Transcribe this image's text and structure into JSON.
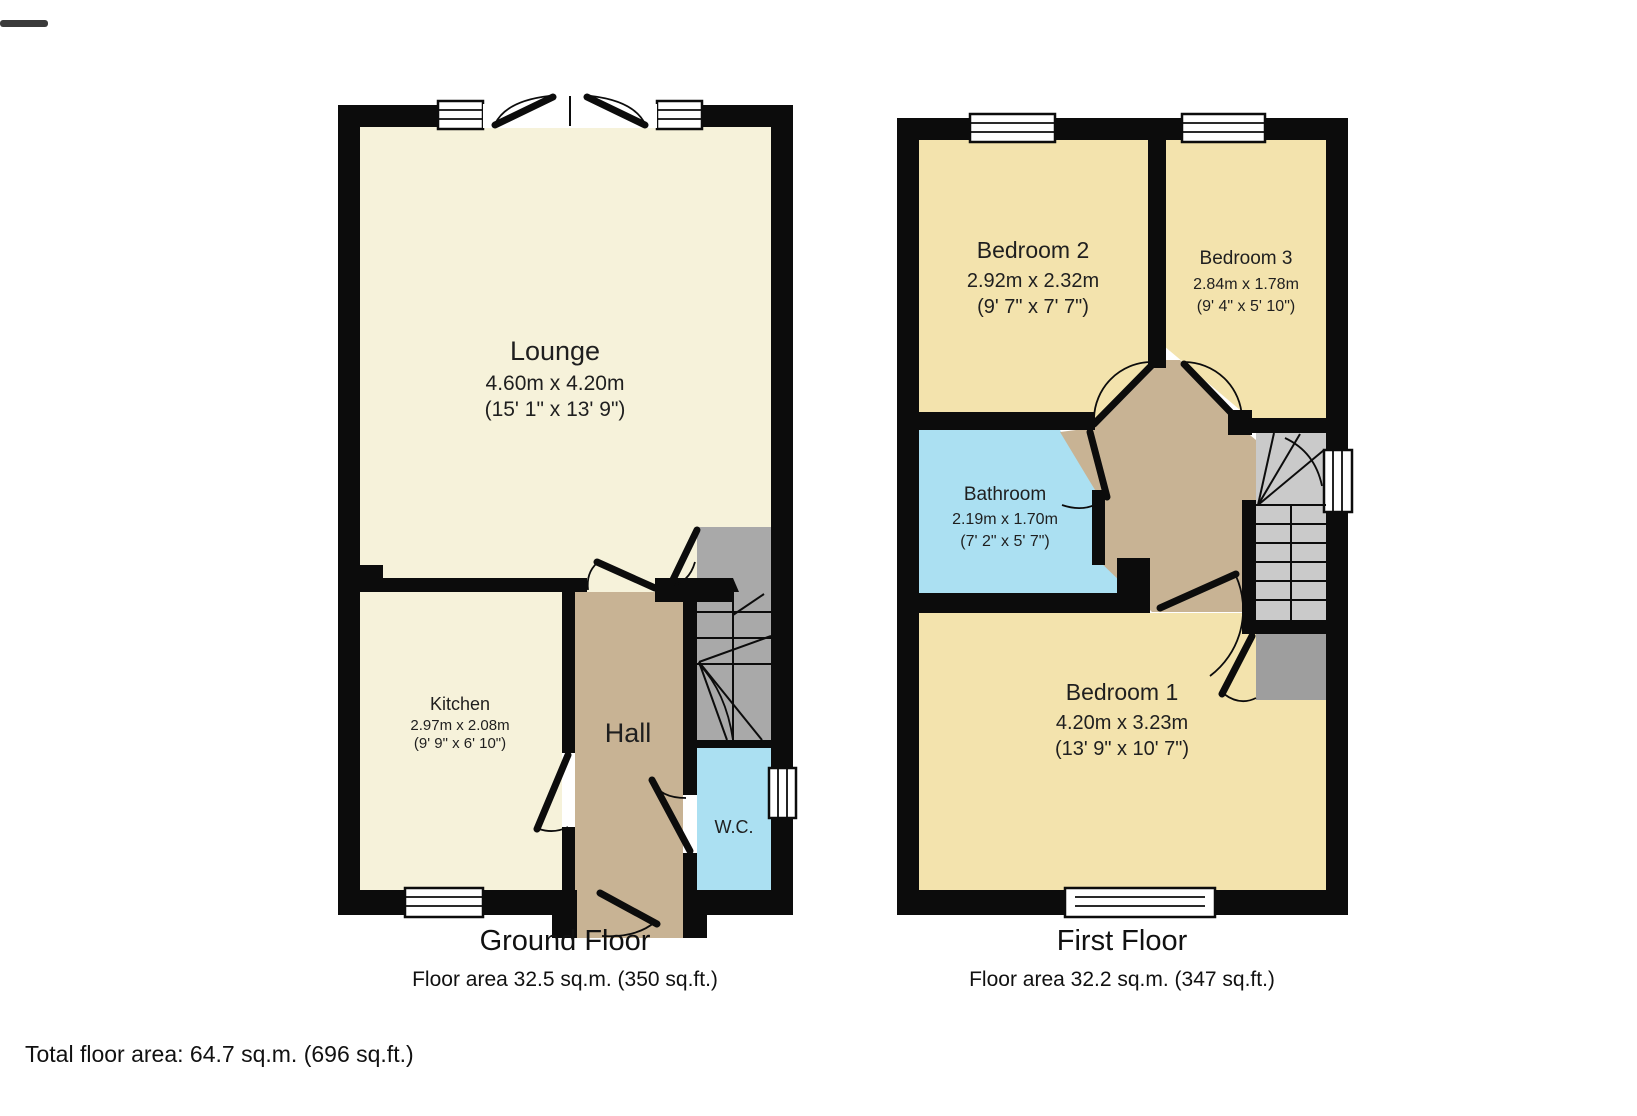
{
  "page": {
    "background": "#ffffff",
    "total_area_label": "Total floor area: 64.7 sq.m. (696 sq.ft.)"
  },
  "colors": {
    "wall": "#0c0c0c",
    "pale_room": "#f6f2da",
    "bedroom_tan": "#f3e3ad",
    "hall_brown": "#c8b394",
    "wet_room_blue": "#abe0f2",
    "stairs_gray_ground": "#a9a9a9",
    "stairs_gray_first": "#cacaca",
    "cupboard_gray": "#9e9e9e"
  },
  "ground_floor": {
    "caption": "Ground Floor",
    "area_line": "Floor area 32.5 sq.m. (350 sq.ft.)",
    "rooms": {
      "lounge": {
        "name": "Lounge",
        "dims_m": "4.60m x 4.20m",
        "dims_ft": "(15' 1\" x 13' 9\")"
      },
      "kitchen": {
        "name": "Kitchen",
        "dims_m": "2.97m x 2.08m",
        "dims_ft": "(9' 9\" x 6' 10\")"
      },
      "hall": {
        "name": "Hall"
      },
      "wc": {
        "name": "W.C."
      }
    }
  },
  "first_floor": {
    "caption": "First Floor",
    "area_line": "Floor area 32.2 sq.m. (347 sq.ft.)",
    "rooms": {
      "bedroom2": {
        "name": "Bedroom 2",
        "dims_m": "2.92m x 2.32m",
        "dims_ft": "(9' 7\" x 7' 7\")"
      },
      "bedroom3": {
        "name": "Bedroom 3",
        "dims_m": "2.84m x 1.78m",
        "dims_ft": "(9' 4\" x 5' 10\")"
      },
      "bathroom": {
        "name": "Bathroom",
        "dims_m": "2.19m x 1.70m",
        "dims_ft": "(7' 2\" x 5' 7\")"
      },
      "bedroom1": {
        "name": "Bedroom 1",
        "dims_m": "4.20m x 3.23m",
        "dims_ft": "(13' 9\" x 10' 7\")"
      }
    }
  }
}
